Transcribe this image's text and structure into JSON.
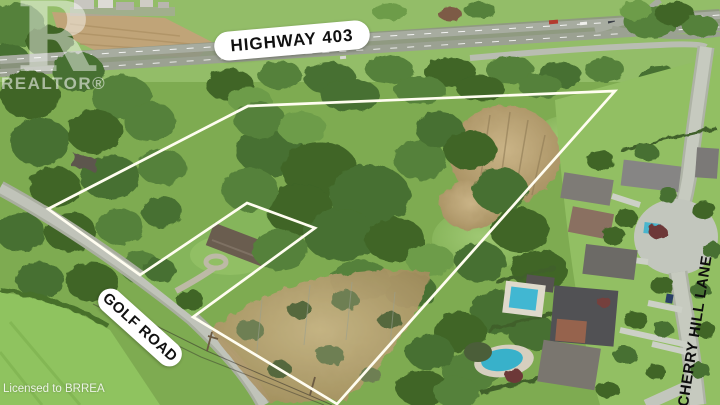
{
  "scene": {
    "description": "Aerial drone photo of a wooded vacant-land real-estate parcel outlined in white, bounded by Highway 403 at top, Golf Road at lower left and Cherry Hill Lane residential street at right, with an excluded house lot notch along Golf Road"
  },
  "labels": {
    "highway": "HIGHWAY 403",
    "golf_road": "GOLF ROAD",
    "cherry_hill": "CHERRY HILL LANE"
  },
  "watermark": {
    "logo_letter": "R",
    "brand": "REALTOR®"
  },
  "license": {
    "text": "Licensed to BRREA"
  },
  "boundary": {
    "points": "48,209 248,106 615,91 337,404 193,317 315,228 247,203 140,275",
    "color": "#fffdf0"
  },
  "colors": {
    "outline_white": "#fffdf0",
    "label_pill_bg": "#ffffff",
    "label_text": "#101010",
    "forest_dark": "#3f6527",
    "meadow_green": "#8ab35c",
    "marsh_tan": "#b3a071",
    "road_gray": "#c0c3b9",
    "highway_gray": "#a7aca0",
    "pool_turquoise": "#41b7d2"
  }
}
